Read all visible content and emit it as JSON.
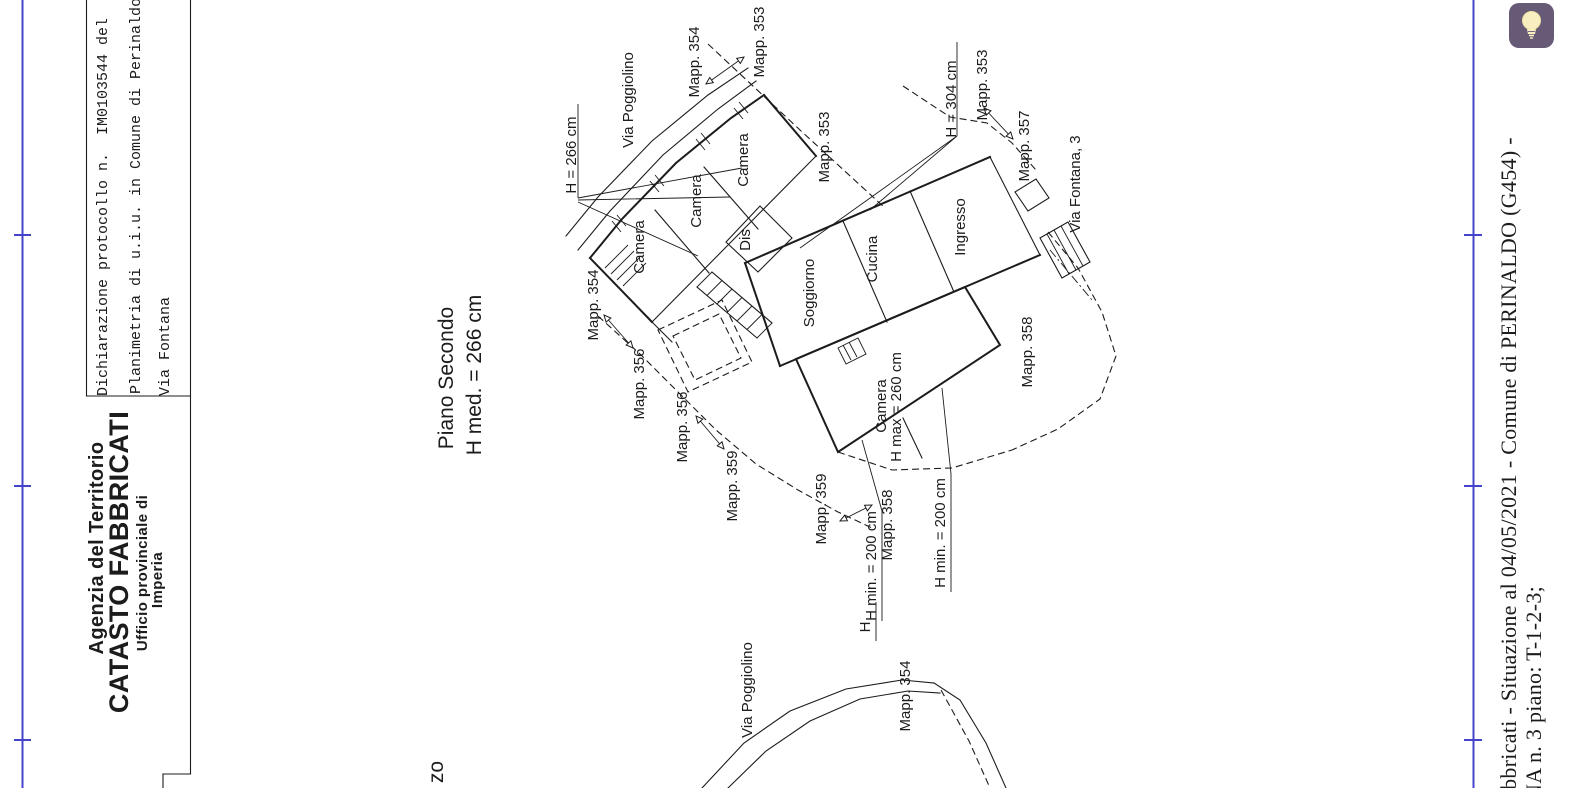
{
  "title_block": {
    "protocol": {
      "line1": "Dichiarazione protocollo n.  IM0103544 del",
      "line2": "Planimetria di u.i.u. in Comune di Perinaldo",
      "line3": "Via Fontana"
    },
    "agency": {
      "line1": "Agenzia del Territorio",
      "line2": "CATASTO FABBRICATI",
      "line3": "Ufficio provinciale di",
      "line4": "Imperia"
    }
  },
  "plan_title": {
    "floor": "Piano Secondo",
    "height": "H med. = 266 cm"
  },
  "floor_plan": {
    "streets": {
      "via_poggiolino": "Via Poggiolino",
      "via_fontana": "Via Fontana, 3"
    },
    "parcels": {
      "mapp_354_top": "Mapp. 354",
      "mapp_353_top": "Mapp. 353",
      "mapp_353_mid": "Mapp. 353",
      "mapp_353_right": "Mapp. 353",
      "mapp_357": "Mapp. 357",
      "mapp_354_left": "Mapp. 354",
      "mapp_356_a": "Mapp. 356",
      "mapp_356_b": "Mapp. 356",
      "mapp_359_a": "Mapp. 359",
      "mapp_359_b": "Mapp. 359",
      "mapp_358_small": "Mapp. 358",
      "mapp_358_big": "Mapp. 358"
    },
    "rooms": {
      "camera_1": "Camera",
      "camera_2": "Camera",
      "camera_3": "Camera",
      "dis": "Dis",
      "soggiorno": "Soggiorno",
      "cucina": "Cucina",
      "ingresso": "Ingresso",
      "camera_4": "Camera"
    },
    "heights": {
      "h_266": "H = 266 cm",
      "h_304": "H = 304 cm",
      "h_max_260": "H max = 260 cm",
      "h_min_left": "H min. = 200 cm",
      "h_min_right": "H min. = 200 cm"
    }
  },
  "lower_plan": {
    "via_poggiolino": "Via Poggiolino",
    "mapp_354": "Mapp. 354",
    "h_fragment": "H",
    "title_fragment": "zo"
  },
  "footer": {
    "line1": "abbricati - Situazione al 04/05/2021 - Comune di PERINALDO (G454) -",
    "line2": "NA n. 3 piano: T-1-2-3;"
  },
  "icons": {
    "lightbulb_button": "lightbulb-icon"
  },
  "colors": {
    "fold_mark": "#4343cc",
    "ink": "#1c1c1c",
    "bulb_button_bg": "#675a76",
    "bulb_fill": "#f8eec0"
  }
}
